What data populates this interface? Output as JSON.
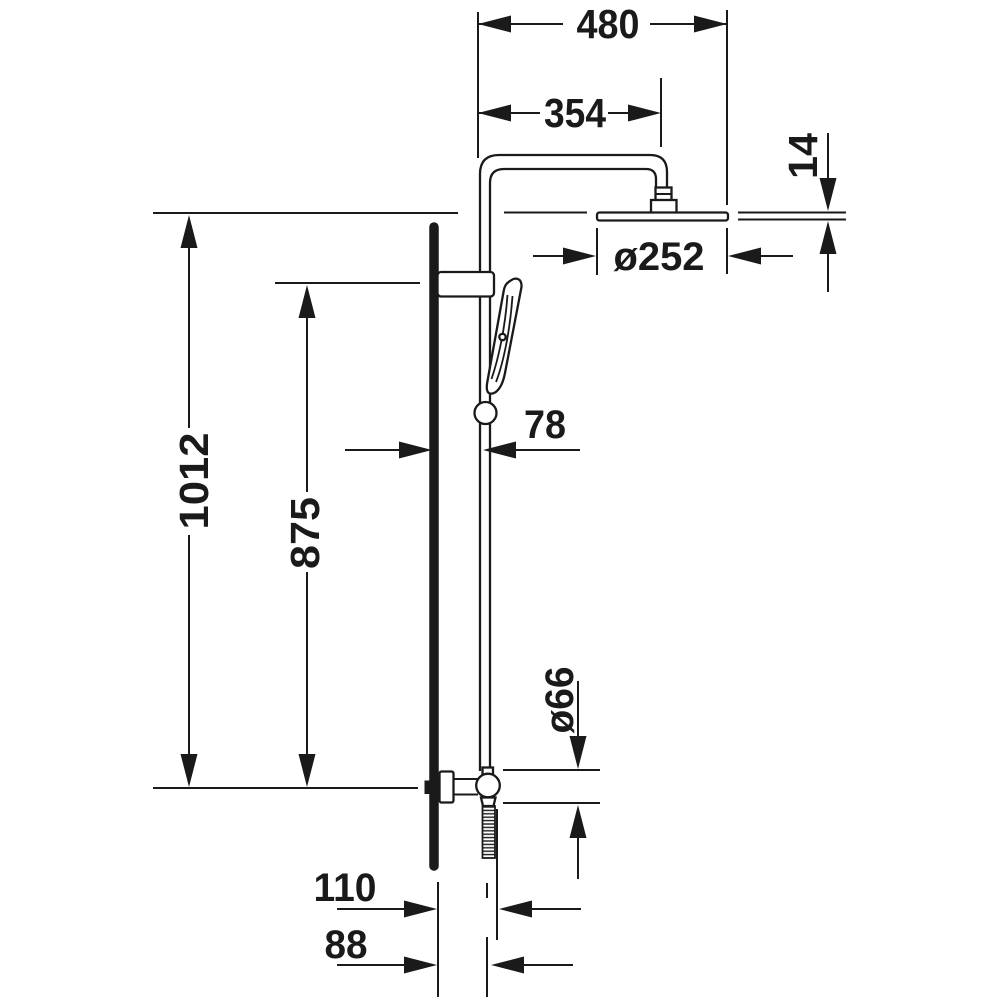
{
  "drawing": {
    "type": "technical-dimension-drawing",
    "subject": "shower-system-side-elevation",
    "background_color": "#ffffff",
    "line_color": "#1a1a1a",
    "dimensions": {
      "arm_total_width": "480",
      "arm_projection": "354",
      "head_plate_thickness": "14",
      "head_diameter": "ø252",
      "total_height": "1012",
      "rail_height": "875",
      "rail_wall_offset": "78",
      "outlet_diameter": "ø66",
      "hose_offset_outer": "110",
      "hose_offset_center": "88"
    }
  }
}
